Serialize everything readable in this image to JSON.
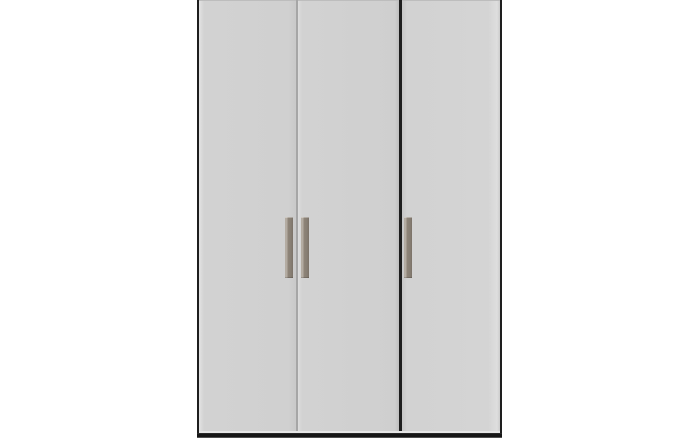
{
  "scene": {
    "description": "Front view of a tall three-door wardrobe with a dark frame, light grey flat door panels, vertical taupe bar handles and a dark plinth base, on a plain white background",
    "background_color": "#ffffff"
  },
  "wardrobe": {
    "door_count": 3,
    "handle_count": 3,
    "doors": [
      {
        "name": "left-door",
        "handle_side": "right"
      },
      {
        "name": "middle-door",
        "handle_side": "left"
      },
      {
        "name": "right-door",
        "handle_side": "left"
      }
    ],
    "colors": {
      "background": "#ffffff",
      "door": "#d2d2d2",
      "door_gap": "#a6a6a6",
      "frame": "#1e1e1e",
      "base": "#161616",
      "handle": "#8e8478",
      "handle_highlight": "#b4aca2"
    }
  }
}
